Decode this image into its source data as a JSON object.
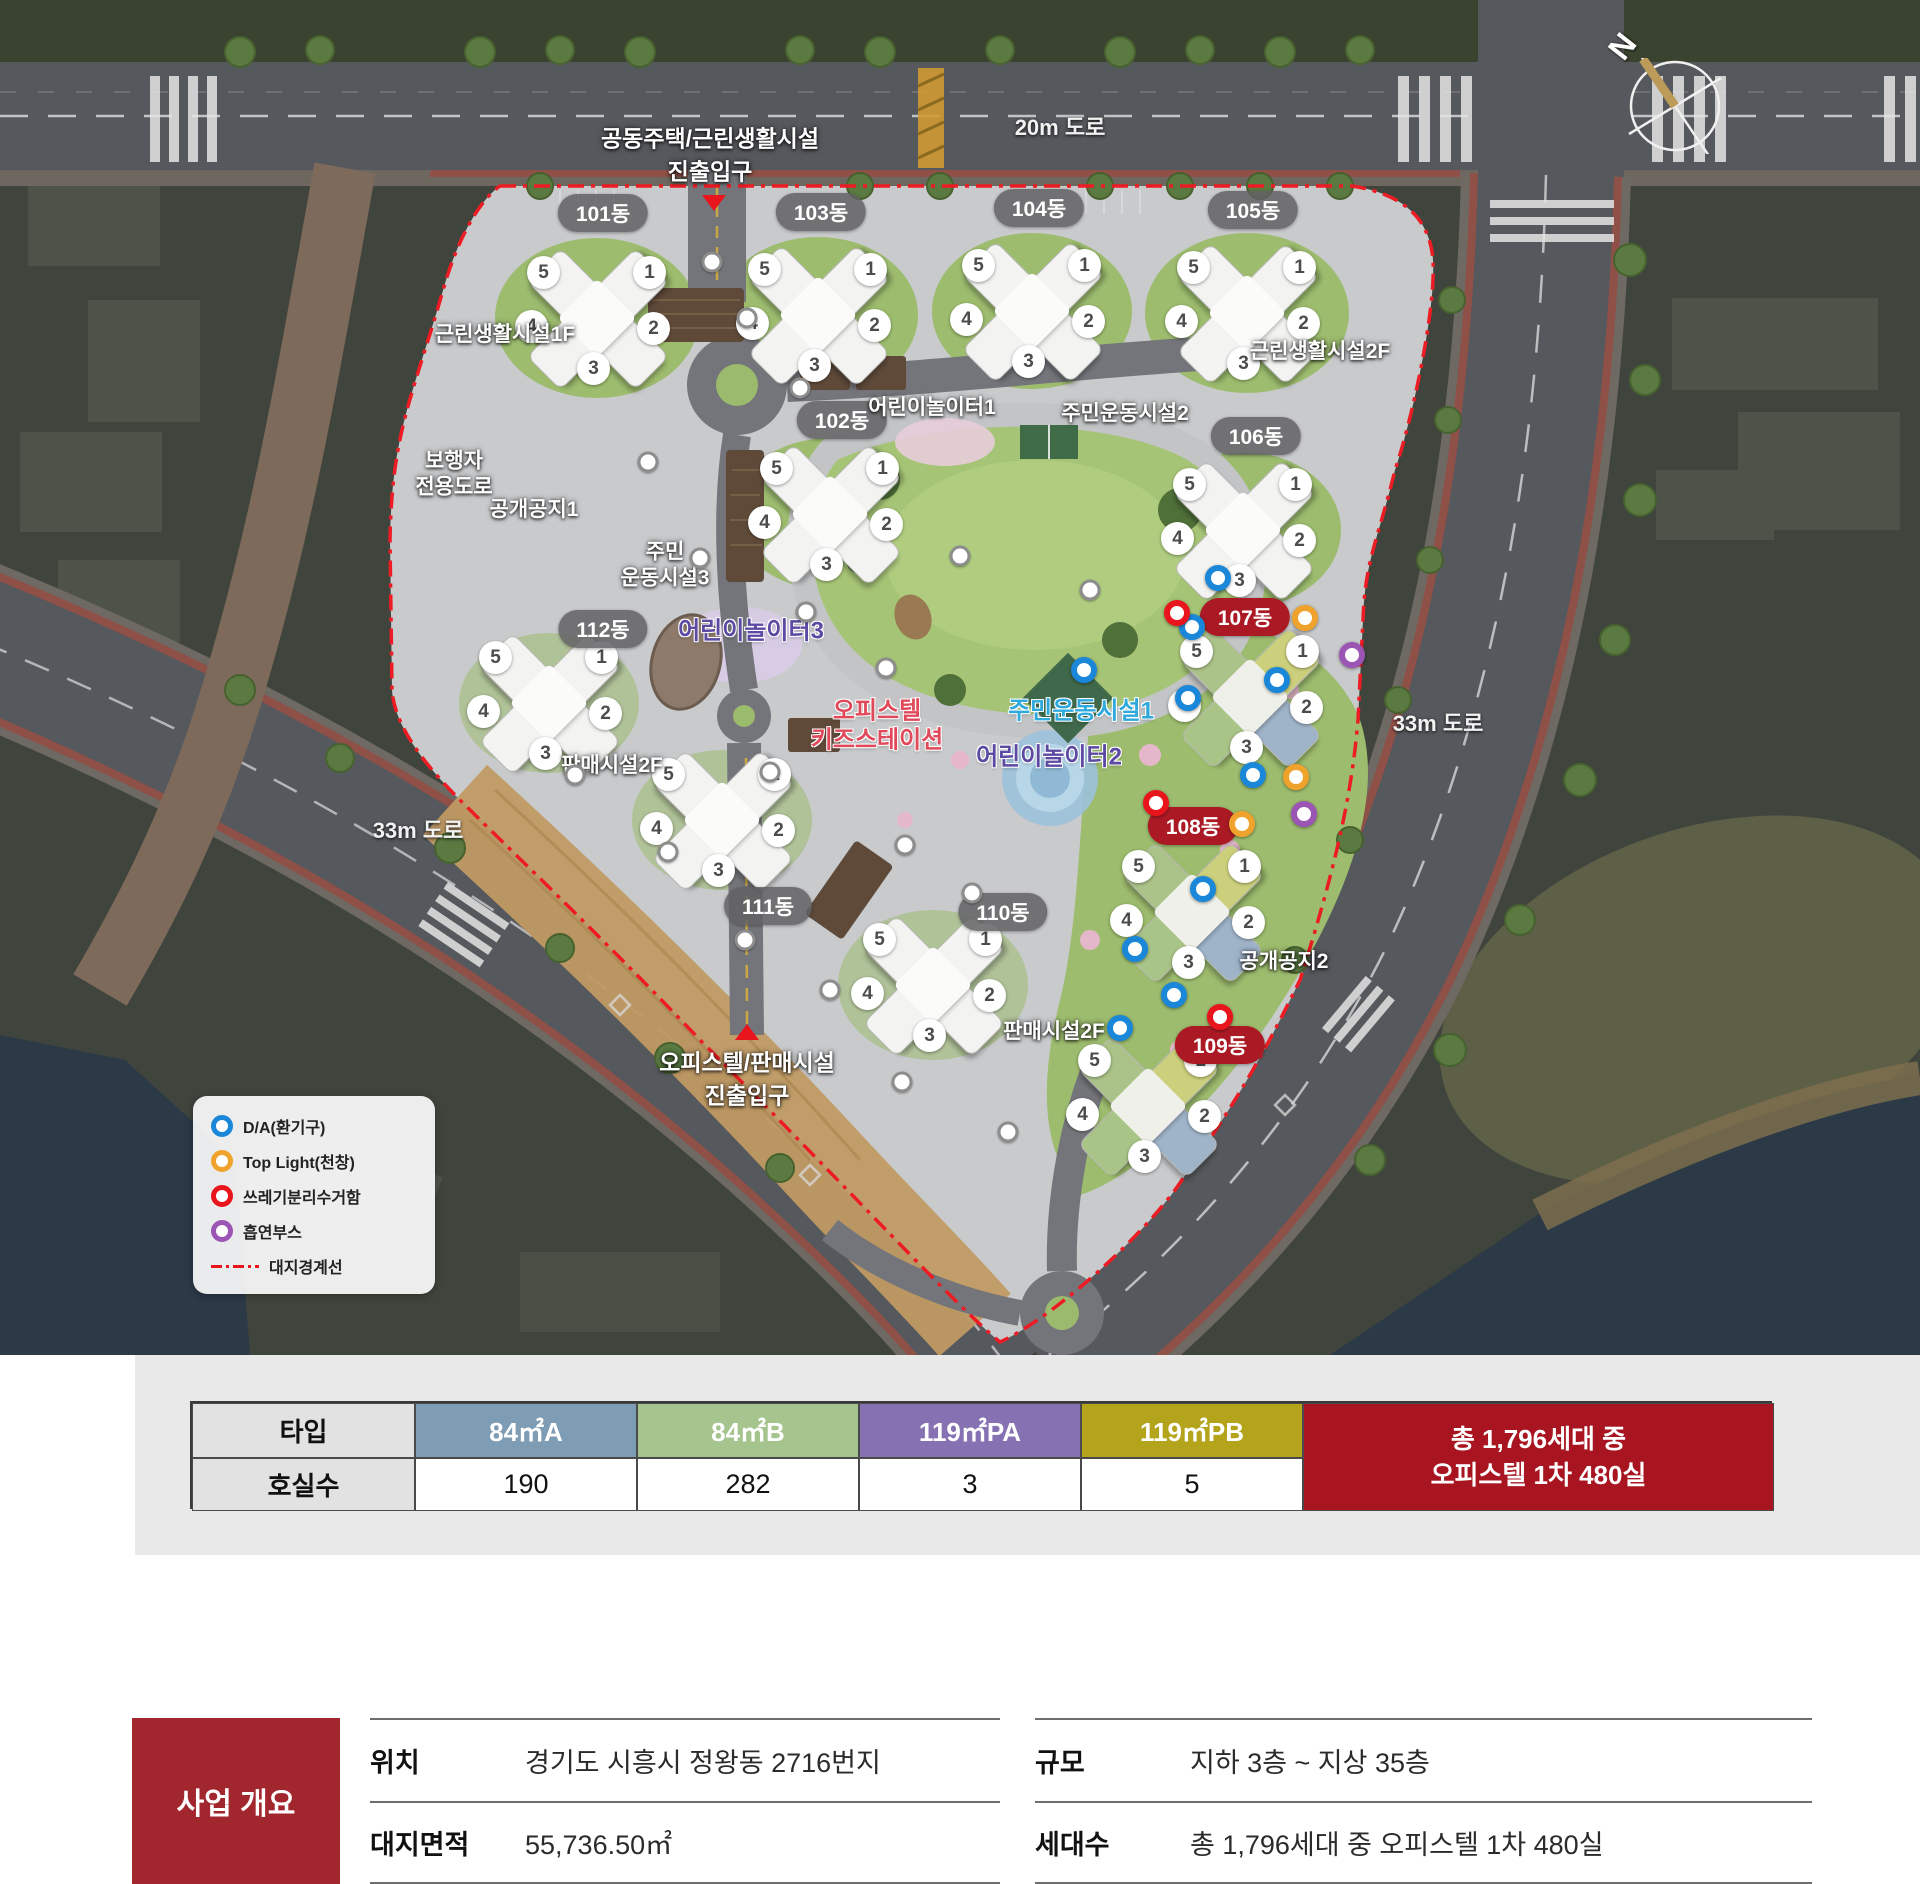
{
  "map": {
    "compass_label": "N",
    "road_labels": [
      {
        "text": "20m 도로",
        "x": 1060,
        "y": 126
      },
      {
        "text": "33m 도로",
        "x": 418,
        "y": 829
      },
      {
        "text": "33m 도로",
        "x": 1438,
        "y": 722
      }
    ],
    "entrances": [
      {
        "id": "north-entrance",
        "lines": [
          "공동주택/근린생활시설",
          "진출입구"
        ],
        "x": 710,
        "y": 156,
        "triangle": "down",
        "tx": 714,
        "ty": 203
      },
      {
        "id": "south-entrance",
        "lines": [
          "오피스텔/판매시설",
          "진출입구"
        ],
        "x": 747,
        "y": 1080,
        "triangle": "up",
        "tx": 747,
        "ty": 1032
      }
    ],
    "buildings": [
      {
        "label": "101동",
        "badge_x": 603,
        "badge_y": 213,
        "x": 597,
        "y": 318,
        "red": false,
        "colored": false
      },
      {
        "label": "102동",
        "badge_x": 842,
        "badge_y": 420,
        "x": 830,
        "y": 514,
        "red": false,
        "colored": false
      },
      {
        "label": "103동",
        "badge_x": 821,
        "badge_y": 212,
        "x": 818,
        "y": 315,
        "red": false,
        "colored": false
      },
      {
        "label": "104동",
        "badge_x": 1039,
        "badge_y": 208,
        "x": 1032,
        "y": 311,
        "red": false,
        "colored": false
      },
      {
        "label": "105동",
        "badge_x": 1253,
        "badge_y": 210,
        "x": 1247,
        "y": 313,
        "red": false,
        "colored": false
      },
      {
        "label": "106동",
        "badge_x": 1256,
        "badge_y": 436,
        "x": 1243,
        "y": 530,
        "red": false,
        "colored": false
      },
      {
        "label": "107동",
        "badge_x": 1245,
        "badge_y": 617,
        "x": 1250,
        "y": 697,
        "red": true,
        "colored": true
      },
      {
        "label": "108동",
        "badge_x": 1193,
        "badge_y": 826,
        "x": 1192,
        "y": 912,
        "red": true,
        "colored": true
      },
      {
        "label": "109동",
        "badge_x": 1220,
        "badge_y": 1045,
        "x": 1148,
        "y": 1106,
        "red": true,
        "colored": true
      },
      {
        "label": "110동",
        "badge_x": 1003,
        "badge_y": 912,
        "x": 933,
        "y": 985,
        "red": false,
        "colored": false
      },
      {
        "label": "111동",
        "badge_x": 768,
        "badge_y": 906,
        "x": 722,
        "y": 820,
        "red": false,
        "colored": false
      },
      {
        "label": "112동",
        "badge_x": 603,
        "badge_y": 629,
        "x": 549,
        "y": 703,
        "red": false,
        "colored": false
      }
    ],
    "wing_numbers": [
      "5",
      "1",
      "4",
      "2",
      "3"
    ],
    "facility_labels": [
      {
        "lines": [
          "근린생활시설1F"
        ],
        "x": 505,
        "y": 335,
        "style": "white"
      },
      {
        "lines": [
          "근린생활시설2F"
        ],
        "x": 1320,
        "y": 352,
        "style": "white"
      },
      {
        "lines": [
          "어린이놀이터1"
        ],
        "x": 932,
        "y": 408,
        "style": "white"
      },
      {
        "lines": [
          "주민운동시설2"
        ],
        "x": 1125,
        "y": 414,
        "style": "white"
      },
      {
        "lines": [
          "보행자",
          "전용도로"
        ],
        "x": 454,
        "y": 474,
        "style": "white"
      },
      {
        "lines": [
          "공개공지1"
        ],
        "x": 534,
        "y": 510,
        "style": "white"
      },
      {
        "lines": [
          "주민",
          "운동시설3"
        ],
        "x": 665,
        "y": 565,
        "style": "white"
      },
      {
        "lines": [
          "어린이놀이터3"
        ],
        "x": 751,
        "y": 631,
        "style": "purple"
      },
      {
        "lines": [
          "오피스텔",
          "키즈스테이션"
        ],
        "x": 877,
        "y": 726,
        "style": "red"
      },
      {
        "lines": [
          "주민운동시설1"
        ],
        "x": 1081,
        "y": 711,
        "style": "cyan"
      },
      {
        "lines": [
          "어린이놀이터2"
        ],
        "x": 1049,
        "y": 757,
        "style": "purple"
      },
      {
        "lines": [
          "공개공지2"
        ],
        "x": 1284,
        "y": 962,
        "style": "white"
      },
      {
        "lines": [
          "판매시설2F"
        ],
        "x": 612,
        "y": 766,
        "style": "white"
      },
      {
        "lines": [
          "판매시설2F"
        ],
        "x": 1054,
        "y": 1032,
        "style": "white"
      }
    ],
    "markers": [
      {
        "type": "da",
        "x": 1218,
        "y": 578
      },
      {
        "type": "da",
        "x": 1192,
        "y": 627
      },
      {
        "type": "da",
        "x": 1277,
        "y": 680
      },
      {
        "type": "da",
        "x": 1188,
        "y": 698
      },
      {
        "type": "da",
        "x": 1253,
        "y": 775
      },
      {
        "type": "da",
        "x": 1203,
        "y": 889
      },
      {
        "type": "da",
        "x": 1174,
        "y": 995
      },
      {
        "type": "da",
        "x": 1135,
        "y": 949
      },
      {
        "type": "da",
        "x": 1120,
        "y": 1028
      },
      {
        "type": "da",
        "x": 1084,
        "y": 670
      },
      {
        "type": "top",
        "x": 1305,
        "y": 618
      },
      {
        "type": "top",
        "x": 1296,
        "y": 777
      },
      {
        "type": "top",
        "x": 1242,
        "y": 824
      },
      {
        "type": "trash",
        "x": 1177,
        "y": 613
      },
      {
        "type": "trash",
        "x": 1156,
        "y": 803
      },
      {
        "type": "trash",
        "x": 1220,
        "y": 1017
      },
      {
        "type": "smoke",
        "x": 1352,
        "y": 655
      },
      {
        "type": "smoke",
        "x": 1304,
        "y": 814
      }
    ],
    "marker_colors": {
      "da": "#1b87d8",
      "top": "#f0a32c",
      "trash": "#e8151d",
      "smoke": "#9b55b4"
    },
    "white_dots": [
      {
        "x": 712,
        "y": 262
      },
      {
        "x": 747,
        "y": 318
      },
      {
        "x": 800,
        "y": 388
      },
      {
        "x": 648,
        "y": 462
      },
      {
        "x": 700,
        "y": 558
      },
      {
        "x": 806,
        "y": 612
      },
      {
        "x": 960,
        "y": 556
      },
      {
        "x": 886,
        "y": 668
      },
      {
        "x": 770,
        "y": 772
      },
      {
        "x": 905,
        "y": 845
      },
      {
        "x": 972,
        "y": 893
      },
      {
        "x": 668,
        "y": 852
      },
      {
        "x": 575,
        "y": 775
      },
      {
        "x": 830,
        "y": 990
      },
      {
        "x": 902,
        "y": 1082
      },
      {
        "x": 1008,
        "y": 1132
      },
      {
        "x": 745,
        "y": 940
      },
      {
        "x": 1090,
        "y": 590
      }
    ],
    "legend": {
      "items": [
        {
          "key": "da",
          "label": "D/A(환기구)"
        },
        {
          "key": "top",
          "label": "Top Light(천창)"
        },
        {
          "key": "trash",
          "label": "쓰레기분리수거함"
        },
        {
          "key": "smoke",
          "label": "흡연부스"
        }
      ],
      "line_label": "대지경계선"
    }
  },
  "type_table": {
    "row_headers": [
      "타입",
      "호실수"
    ],
    "types": [
      {
        "name": "84㎡A",
        "count": "190",
        "color": "#7f9cb5"
      },
      {
        "name": "84㎡B",
        "count": "282",
        "color": "#a5c48e"
      },
      {
        "name": "119㎡PA",
        "count": "3",
        "color": "#8672b2"
      },
      {
        "name": "119㎡PB",
        "count": "5",
        "color": "#b3a41c"
      }
    ],
    "summary_lines": [
      "총 1,796세대 중",
      "오피스텔 1차 480실"
    ],
    "summary_color": "#a8141f"
  },
  "overview": {
    "title": "사업 개요",
    "columns": [
      {
        "items": [
          {
            "label": "위치",
            "value": "경기도 시흥시 정왕동 2716번지"
          },
          {
            "label": "대지면적",
            "value": "55,736.50㎡"
          }
        ]
      },
      {
        "items": [
          {
            "label": "규모",
            "value": "지하 3층 ~ 지상 35층"
          },
          {
            "label": "세대수",
            "value": "총 1,796세대 중 오피스텔 1차 480실"
          }
        ]
      }
    ]
  }
}
